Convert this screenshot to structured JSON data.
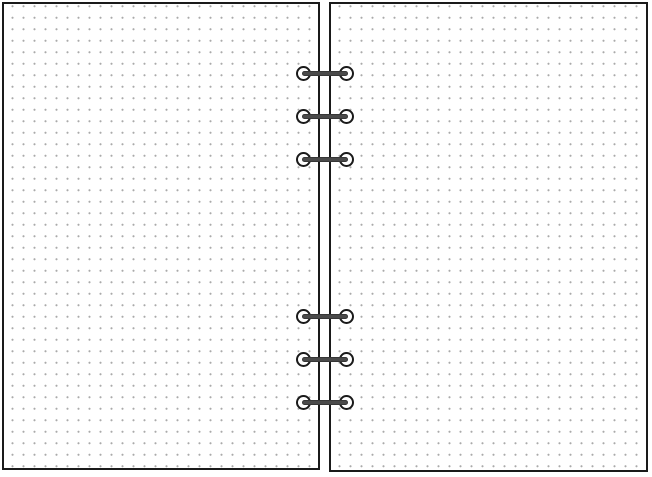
{
  "scene": {
    "description": "Open six-ring planner binder showing two blank dot-grid pages",
    "pages": [
      {
        "id": "left",
        "style": "dot-grid",
        "content": "blank"
      },
      {
        "id": "right",
        "style": "dot-grid",
        "content": "blank"
      }
    ],
    "rings": {
      "total": 6,
      "groups": [
        {
          "position": "top",
          "count": 3
        },
        {
          "position": "bottom",
          "count": 3
        }
      ]
    },
    "colors": {
      "background": "#ffffff",
      "page_fill": "#ffffff",
      "page_border": "#1a1a1a",
      "dot": "#aaaaaa",
      "ring_bar": "#4a4a4a",
      "eyelet_outline": "#1a1a1a",
      "eyelet_fill": "#ffffff"
    }
  }
}
